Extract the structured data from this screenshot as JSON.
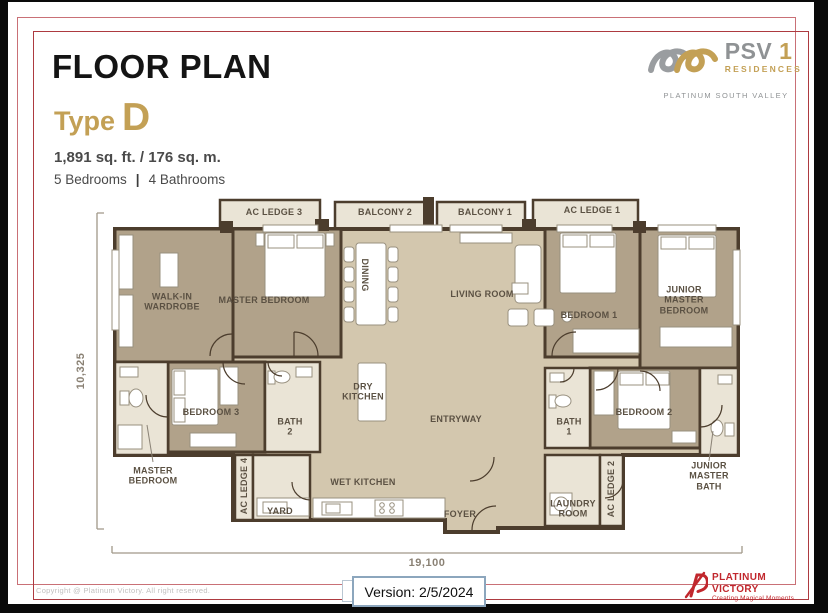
{
  "header": {
    "title": "FLOOR PLAN",
    "type_word": "Type",
    "type_letter": "D",
    "area": "1,891 sq. ft. / 176 sq. m.",
    "bedrooms": "5 Bedrooms",
    "separator": "|",
    "bathrooms": "4 Bathrooms"
  },
  "brand": {
    "psv": "PSV ",
    "one": "1",
    "residences": "RESIDENCES",
    "tagline": "PLATINUM SOUTH VALLEY",
    "gold": "#c3a055",
    "gray": "#8f9294"
  },
  "plan": {
    "colors": {
      "wall": "#4c3d2d",
      "floor_common": "#d3c7ae",
      "floor_bedroom": "#b1a28a",
      "floor_wet": "#eae4d6",
      "label_text": "#5b5143"
    },
    "rooms": [
      {
        "label": "AC LEDGE 3"
      },
      {
        "label": "BALCONY 2"
      },
      {
        "label": "BALCONY 1"
      },
      {
        "label": "AC LEDGE 1"
      },
      {
        "label": "WALK-IN\nWARDROBE"
      },
      {
        "label": "MASTER BEDROOM"
      },
      {
        "label": "DINING"
      },
      {
        "label": "LIVING ROOM"
      },
      {
        "label": "BEDROOM 1"
      },
      {
        "label": "JUNIOR MASTER\nBEDROOM"
      },
      {
        "label": "BEDROOM 3"
      },
      {
        "label": "BATH\n2"
      },
      {
        "label": "DRY\nKITCHEN"
      },
      {
        "label": "ENTRYWAY"
      },
      {
        "label": "MASTER\nBEDROOM"
      },
      {
        "label": "AC LEDGE 4"
      },
      {
        "label": "YARD"
      },
      {
        "label": "WET KITCHEN"
      },
      {
        "label": "FOYER"
      },
      {
        "label": "BATH\n1"
      },
      {
        "label": "BEDROOM 2"
      },
      {
        "label": "LAUNDRY\nROOM"
      },
      {
        "label": "AC LEDGE 2"
      },
      {
        "label": "JUNIOR\nMASTER\nBATH"
      }
    ],
    "dimensions": {
      "width_label": "19,100",
      "height_label": "10,325"
    }
  },
  "footer": {
    "copyright": "Copyright @ Platinum Victory. All right reserved.",
    "version": "Version: 2/5/2024",
    "logo_name": "PLATINUM VICTORY",
    "logo_tagline": "Creating Magical Moments",
    "red": "#c1272d"
  }
}
